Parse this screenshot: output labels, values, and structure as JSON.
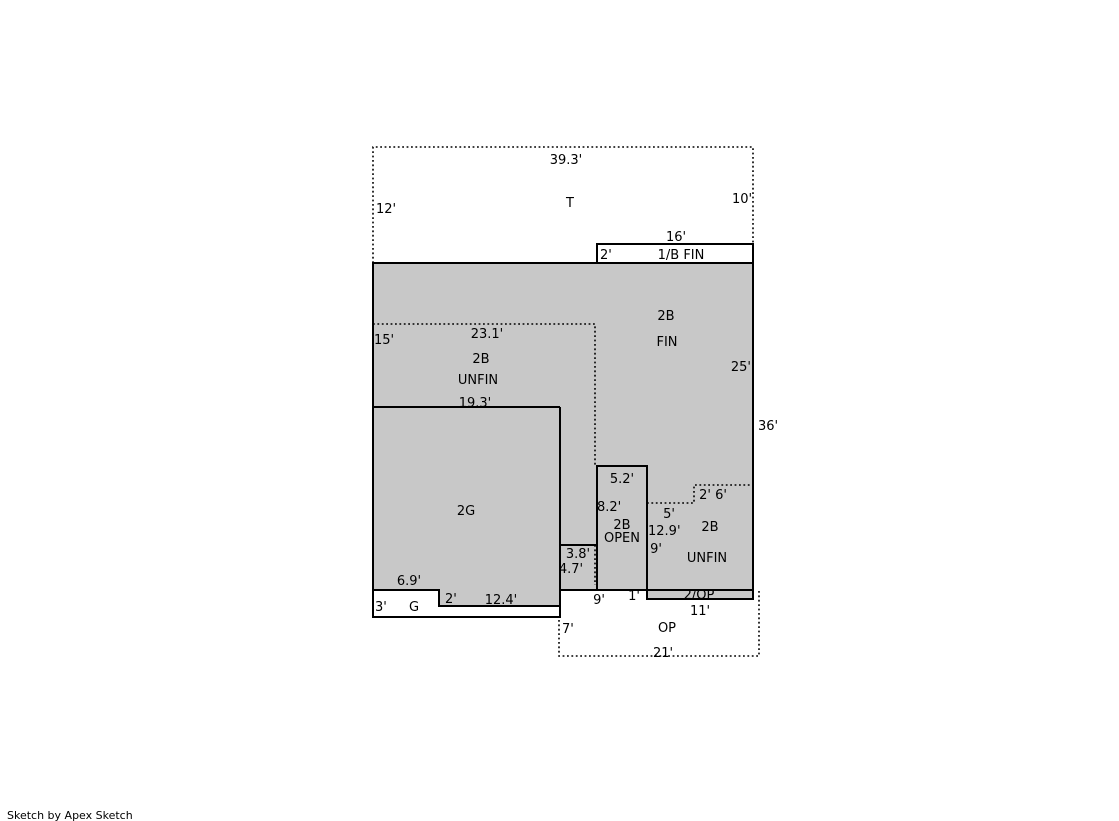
{
  "colors": {
    "area_fill": "#c8c8c8",
    "outline": "#000000",
    "background": "#ffffff"
  },
  "footer": {
    "credit": "Sketch by Apex Sketch"
  },
  "labels": {
    "t_area": "T",
    "t_width": "39.3'",
    "t_left_height": "12'",
    "t_right_height": "10'",
    "fin_1b": "1/B FIN",
    "fin_1b_width": "16'",
    "fin_1b_height": "2'",
    "fin_2b_line1": "2B",
    "fin_2b_line2": "FIN",
    "fin_2b_right_height": "25'",
    "overall_right_height": "36'",
    "unfin_2b_height": "15'",
    "unfin_2b_width": "23.1'",
    "unfin_2b_line1": "2B",
    "unfin_2b_line2": "UNFIN",
    "garage_width": "19.3'",
    "garage_area": "2G",
    "open_2b_width": "5.2'",
    "open_2b_height": "8.2'",
    "open_2b_line1": "2B",
    "open_2b_line2": "OPEN",
    "notch_width": "5'",
    "notch_height": "2'",
    "notch_top_width": "6'",
    "unfin_2b_r_height": "12.9'",
    "unfin_2b_r_lower_height": "9'",
    "unfin_2b_r_line1": "2B",
    "unfin_2b_r_line2": "UNFIN",
    "corridor_width": "3.8'",
    "corridor_height": "4.7'",
    "g_bay_width": "6.9'",
    "g_bay_height": "3'",
    "g_bay": "G",
    "strip_step_height": "2'",
    "strip_width": "12.4'",
    "porch_offset": "9'",
    "porch_step": "1'",
    "op2_strip": "2/OP",
    "op2_strip_width": "11'",
    "op_height": "7'",
    "op_area": "OP",
    "op_width": "21'"
  }
}
